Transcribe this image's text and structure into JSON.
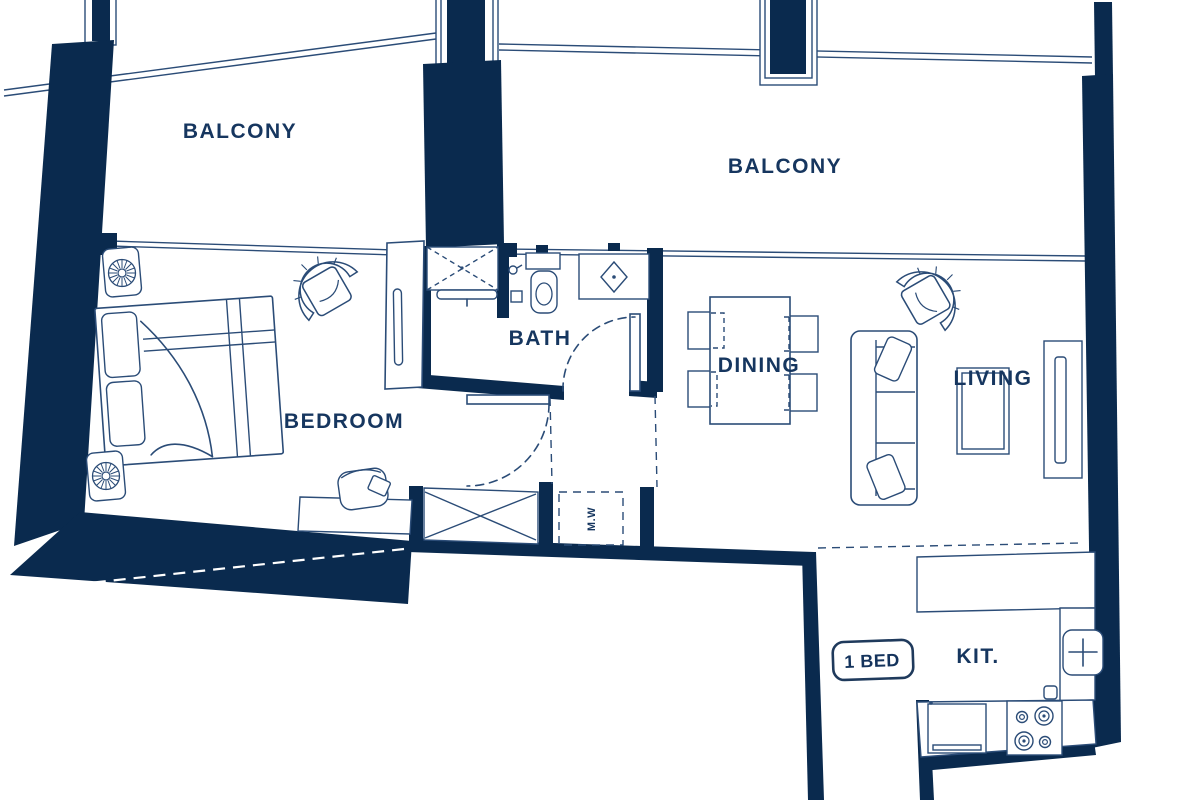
{
  "meta": {
    "type": "apartment-floor-plan",
    "unit_type": "1 BED"
  },
  "labels": {
    "balcony_left": "BALCONY",
    "balcony_right": "BALCONY",
    "bedroom": "BEDROOM",
    "bath": "BATH",
    "dining": "DINING",
    "living": "LIVING",
    "kitchen": "KIT.",
    "washer": "M.W",
    "unit_badge": "1 BED"
  },
  "colors": {
    "wall": "#0a2a4e",
    "line": "#2b4c77",
    "text": "#16365f",
    "background": "#ffffff"
  }
}
